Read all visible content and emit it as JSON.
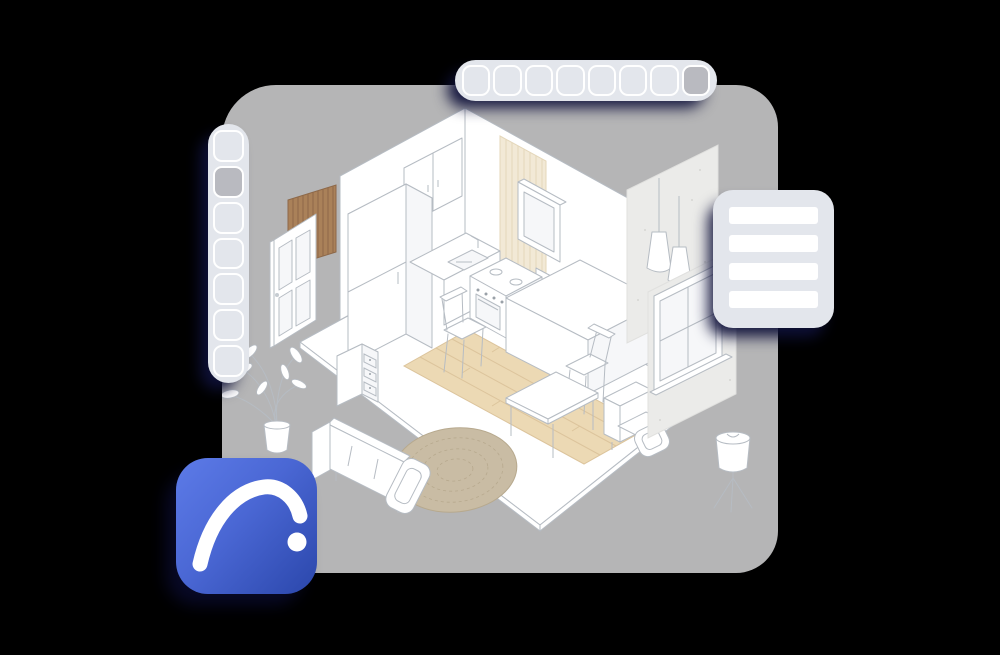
{
  "background_color": "#000000",
  "canvas": {
    "name": "design-canvas",
    "color": "#b5b5b6"
  },
  "colors": {
    "bg": "#000000",
    "canvas": "#b5b5b6",
    "toolbar_bg": "#e3e6ec",
    "button_border": "#ffffff",
    "button_active": "#b9bac0",
    "shadow_navy": "rgba(15,17,58,0.95)",
    "panel_row": "#ffffff",
    "icon_gradient_start": "#5b79e6",
    "icon_gradient_end": "#2d49ae",
    "line": "#b6bcc3",
    "wood_panel": "#aa8159",
    "wood_panel_slat": "#8d6849",
    "wood_floor": "#ecd9b4",
    "wood_floor_line": "#dcc49c",
    "rug": "#c9bca4",
    "rug_line": "#b7a98e",
    "concrete": "#ebebe9",
    "tile": "#f2e9d6",
    "tile_line": "#e4d7ba"
  },
  "top_toolbar": {
    "buttons": [
      {
        "active": false
      },
      {
        "active": false
      },
      {
        "active": false
      },
      {
        "active": false
      },
      {
        "active": false
      },
      {
        "active": false
      },
      {
        "active": false
      },
      {
        "active": true
      }
    ]
  },
  "left_toolbar": {
    "buttons": [
      {
        "active": false
      },
      {
        "active": true
      },
      {
        "active": false
      },
      {
        "active": false
      },
      {
        "active": false
      },
      {
        "active": false
      },
      {
        "active": false
      }
    ]
  },
  "right_panel": {
    "rows": [
      {
        "type": "row"
      },
      {
        "type": "row"
      },
      {
        "type": "row"
      },
      {
        "type": "row"
      }
    ]
  },
  "app_icon": {
    "name": "archicad-logo",
    "glyph": "arc-and-dot"
  },
  "scene": {
    "objects": [
      "floor",
      "wood-floor-strip",
      "left-wall",
      "right-wall",
      "tile-backsplash",
      "upper-cabinets",
      "tall-cabinet",
      "sink-counter",
      "wall-cabinet",
      "stove",
      "kitchen-island",
      "dining-chair-left",
      "dining-chair-right",
      "coffee-table",
      "armchair",
      "sofa",
      "rug",
      "potted-plant",
      "drawer-unit",
      "door",
      "wood-slat-panel",
      "concrete-panel-pendants",
      "pendant-lamps",
      "concrete-panel-window",
      "window",
      "floor-lamp"
    ]
  }
}
